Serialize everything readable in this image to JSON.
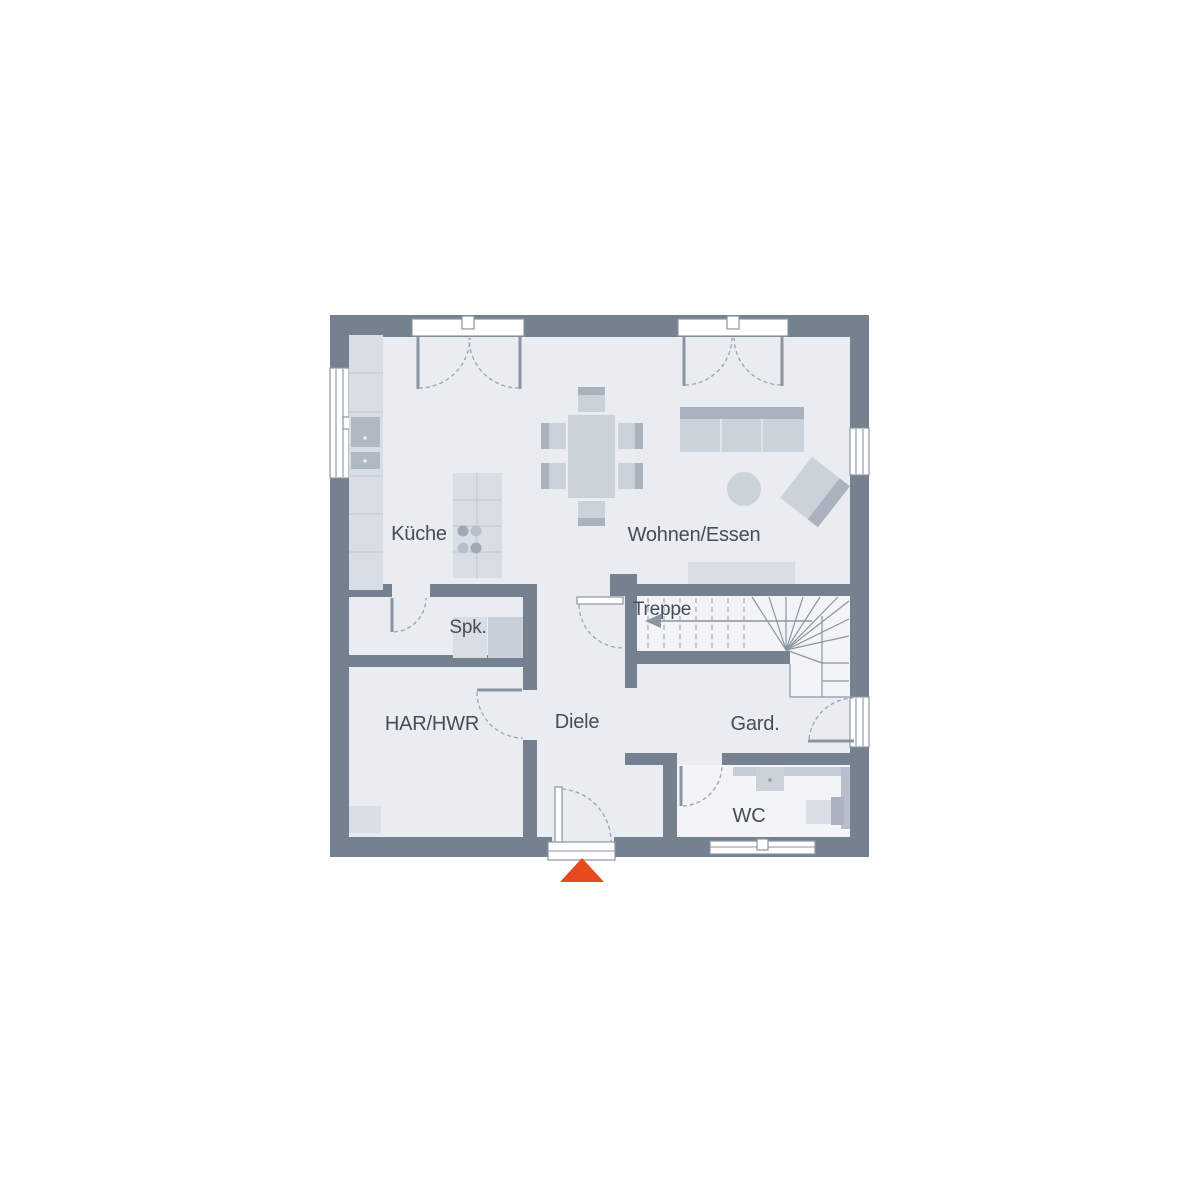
{
  "floorplan": {
    "title": "ground-floor-plan",
    "rooms": [
      {
        "id": "kueche",
        "label": "Küche"
      },
      {
        "id": "wohnen-essen",
        "label": "Wohnen/Essen"
      },
      {
        "id": "treppe",
        "label": "Treppe"
      },
      {
        "id": "spk",
        "label": "Spk."
      },
      {
        "id": "har-hwr",
        "label": "HAR/HWR"
      },
      {
        "id": "diele",
        "label": "Diele"
      },
      {
        "id": "gard",
        "label": "Gard."
      },
      {
        "id": "wc",
        "label": "WC"
      }
    ],
    "markers": {
      "entrance": {
        "shape": "triangle",
        "direction": "up"
      },
      "stairs_arrow": {
        "shape": "arrow",
        "direction": "left"
      }
    },
    "colors": {
      "wall": "#76818f",
      "floor": "#e9edf2",
      "floor_light": "#f2f4f7",
      "furniture": "#ccd2da",
      "furniture_light": "#d9dde4",
      "furniture_dark": "#a9b2bd",
      "appliance": "#b0b8c4",
      "line": "#8b95a1",
      "accent": "#e8491f",
      "text": "#454d57",
      "background": "#ffffff"
    }
  }
}
